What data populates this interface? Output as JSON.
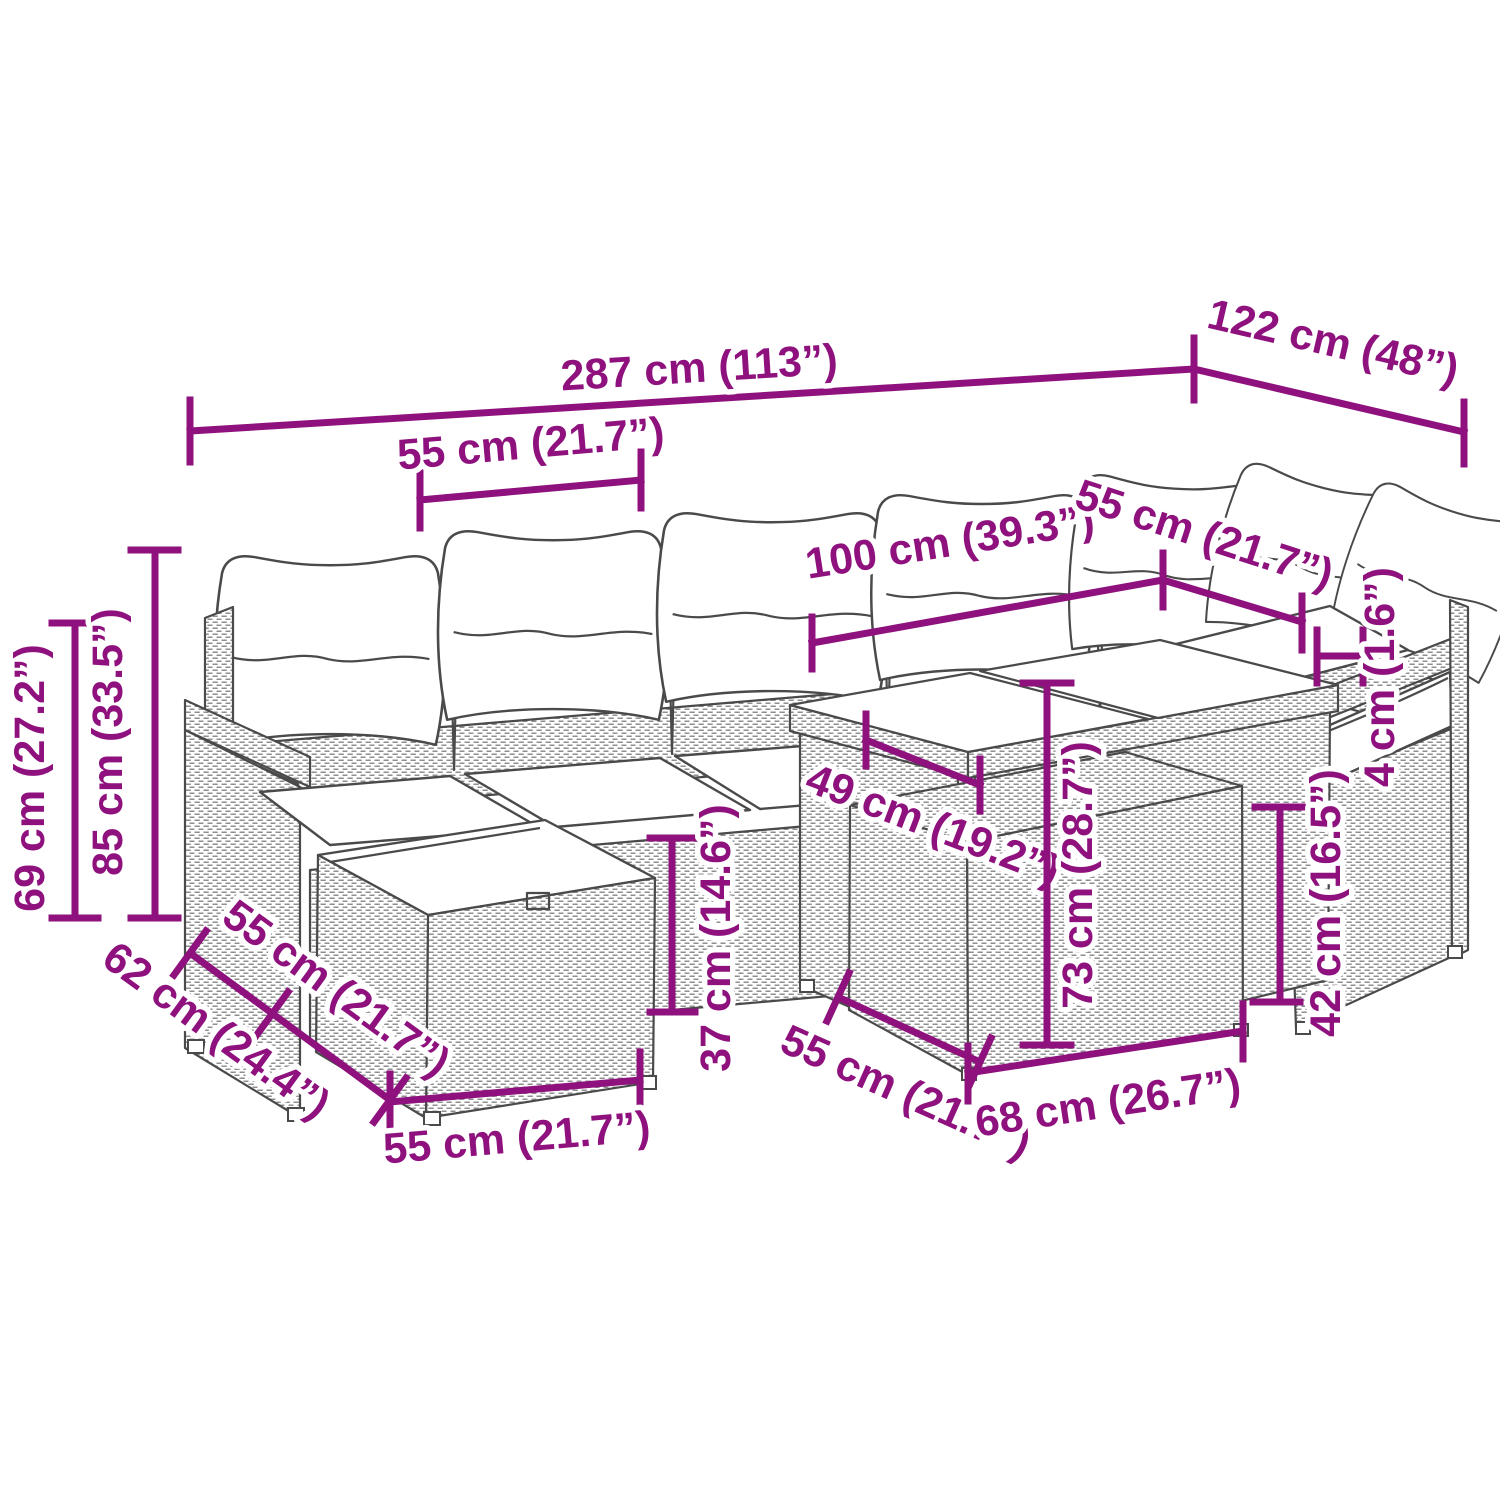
{
  "diagram": {
    "title": "Garden lounge set dimension drawing",
    "accent_color": "#8E117E",
    "sketch_color": "#4a4a4a",
    "dimensions": {
      "overall_width": "287 cm (113”)",
      "overall_depth": "122 cm (48”)",
      "seat_module_width": "55 cm (21.7”)",
      "table_length": "100 cm (39.3”)",
      "table_depth": "55 cm (21.7”)",
      "glass_thickness": "4 cm (1.6”)",
      "backrest_height": "69 cm (27.2”)",
      "overall_height": "85 cm (33.5”)",
      "ottoman_total_depth": "62 cm (24.4”)",
      "ottoman_seat_depth": "55 cm (21.7”)",
      "ottoman_width": "55 cm (21.7”)",
      "frame_seat_height": "37 cm (14.6”)",
      "table_clearance": "49 cm (19.2”)",
      "table_height": "73 cm (28.7”)",
      "storage_module_depth": "55 cm (21.7”)",
      "storage_module_width": "68 cm (26.7”)",
      "armrest_height": "42 cm (16.5”)"
    }
  }
}
